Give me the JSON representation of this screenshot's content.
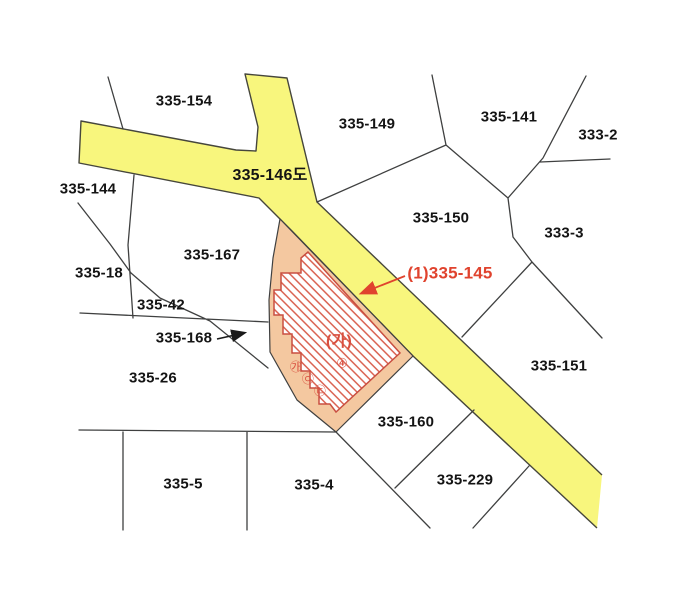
{
  "map": {
    "background": "#ffffff",
    "road": {
      "label": "335-146도"
    },
    "parcels": [
      {
        "id": "335-154",
        "label": "335-154"
      },
      {
        "id": "335-149",
        "label": "335-149"
      },
      {
        "id": "335-141",
        "label": "335-141"
      },
      {
        "id": "333-2",
        "label": "333-2"
      },
      {
        "id": "335-144",
        "label": "335-144"
      },
      {
        "id": "335-150",
        "label": "335-150"
      },
      {
        "id": "333-3",
        "label": "333-3"
      },
      {
        "id": "335-167",
        "label": "335-167"
      },
      {
        "id": "335-18",
        "label": "335-18"
      },
      {
        "id": "335-42",
        "label": "335-42"
      },
      {
        "id": "335-168",
        "label": "335-168"
      },
      {
        "id": "335-26",
        "label": "335-26"
      },
      {
        "id": "335-151",
        "label": "335-151"
      },
      {
        "id": "335-160",
        "label": "335-160"
      },
      {
        "id": "335-229",
        "label": "335-229"
      },
      {
        "id": "335-5",
        "label": "335-5"
      },
      {
        "id": "335-4",
        "label": "335-4"
      }
    ],
    "subject_parcel": {
      "callout": "(1)335-145",
      "interior_label": "(가)",
      "interior_number": "④",
      "edge_markers": [
        "㉮",
        "㉧",
        "㉢"
      ]
    },
    "colors": {
      "road_fill": "#f8f67d",
      "road_border": "#46463c",
      "parcel_line": "#3f4040",
      "subject_area_fill": "#f4c8a0",
      "hatch_line": "#d9604f",
      "hatch_border": "#c94f41",
      "callout_color": "#e0432e",
      "label_color": "#141414",
      "background": "#ffffff"
    }
  }
}
